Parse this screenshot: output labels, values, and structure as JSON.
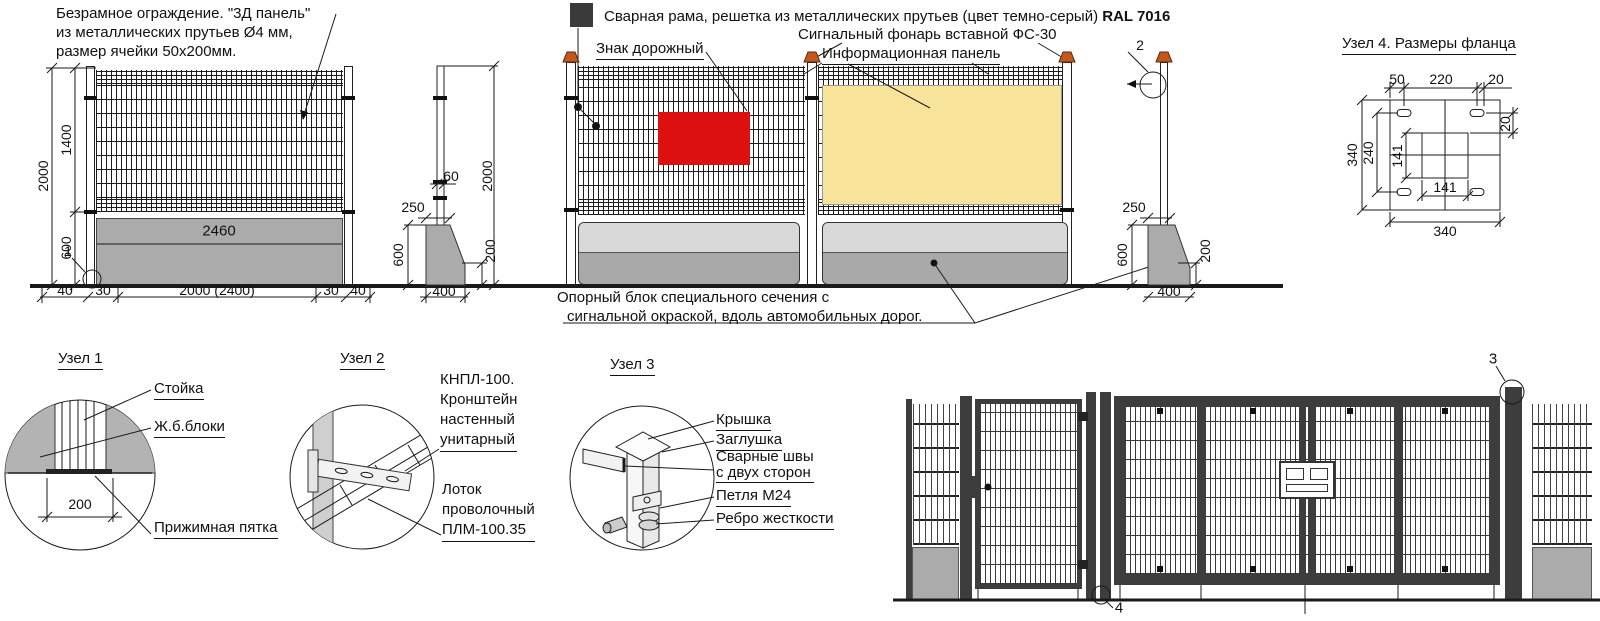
{
  "colors": {
    "line": "#1a1a1a",
    "concrete_gray": "#ababab",
    "concrete_light": "#d9d9d9",
    "sign_red": "#dd1010",
    "info_panel_yellow": "#f7e49a",
    "ral7016_swatch": "#3a3a3a",
    "lamp_orange": "#c4571e",
    "gate_frame": "#3d3d3d"
  },
  "notes": {
    "panel_note_line1": "Безрамное ограждение. \"3Д панель\"",
    "panel_note_line2": "из металлических  прутьев Ø4 мм,",
    "panel_note_line3": "размер ячейки 50х200мм.",
    "frame_note": "Сварная рама, решетка из металлических прутьев  (цвет темно-серый) ",
    "frame_note_bold": "RAL 7016",
    "road_sign_label": "Знак дорожный",
    "signal_lamp_label": "Сигнальный фонарь вставной ФС-30",
    "info_panel_label": "Информационная панель",
    "support_block_line1": "Опорный блок специального сечения с",
    "support_block_line2": "сигнальной окраской, вдоль автомобильных дорог."
  },
  "left_fence": {
    "total_height": "2000",
    "mesh_height": "1400",
    "block_height": "600",
    "block_length": "2460",
    "bottom_dims": [
      "40",
      "30",
      "2000 (2400)",
      "30",
      "40"
    ],
    "node_callout": "1"
  },
  "post_view_left": {
    "post_width": "60",
    "total_height": "2000",
    "block_top_width": "250",
    "block_height": "600",
    "block_edge_height": "200",
    "block_base_width": "400"
  },
  "post_view_right": {
    "node_callout": "2",
    "block_top_width": "250",
    "block_height": "600",
    "block_edge_height": "200",
    "block_base_width": "400"
  },
  "node1": {
    "title": "Узел 1",
    "post_label": "Стойка",
    "blocks_label": "Ж.б.блоки",
    "base_width": "200",
    "heel_label": "Прижимная пятка"
  },
  "node2": {
    "title": "Узел 2",
    "bracket_label": "КНПЛ-100.\nКронштейн\nнастенный\nунитарный",
    "tray_label": "Лоток\nпроволочный\n ПЛМ-100.35"
  },
  "node3": {
    "title": "Узел 3",
    "cap_label": "Крышка",
    "plug_label": "Заглушка",
    "weld_label": "Сварные швы\nс двух сторон",
    "hinge_label": "Петля  М24",
    "rib_label": "Ребро жесткости"
  },
  "node4": {
    "title": "Узел 4. Размеры фланца",
    "top_left": "50",
    "top_center": "220",
    "top_right": "20",
    "right_offset": "20",
    "outer_height": "340",
    "holes_spacing": "240",
    "post_size_v": "141",
    "post_size_h": "141",
    "outer_width": "340"
  },
  "gate": {
    "hinge_callout": "3",
    "base_callout": "4"
  }
}
